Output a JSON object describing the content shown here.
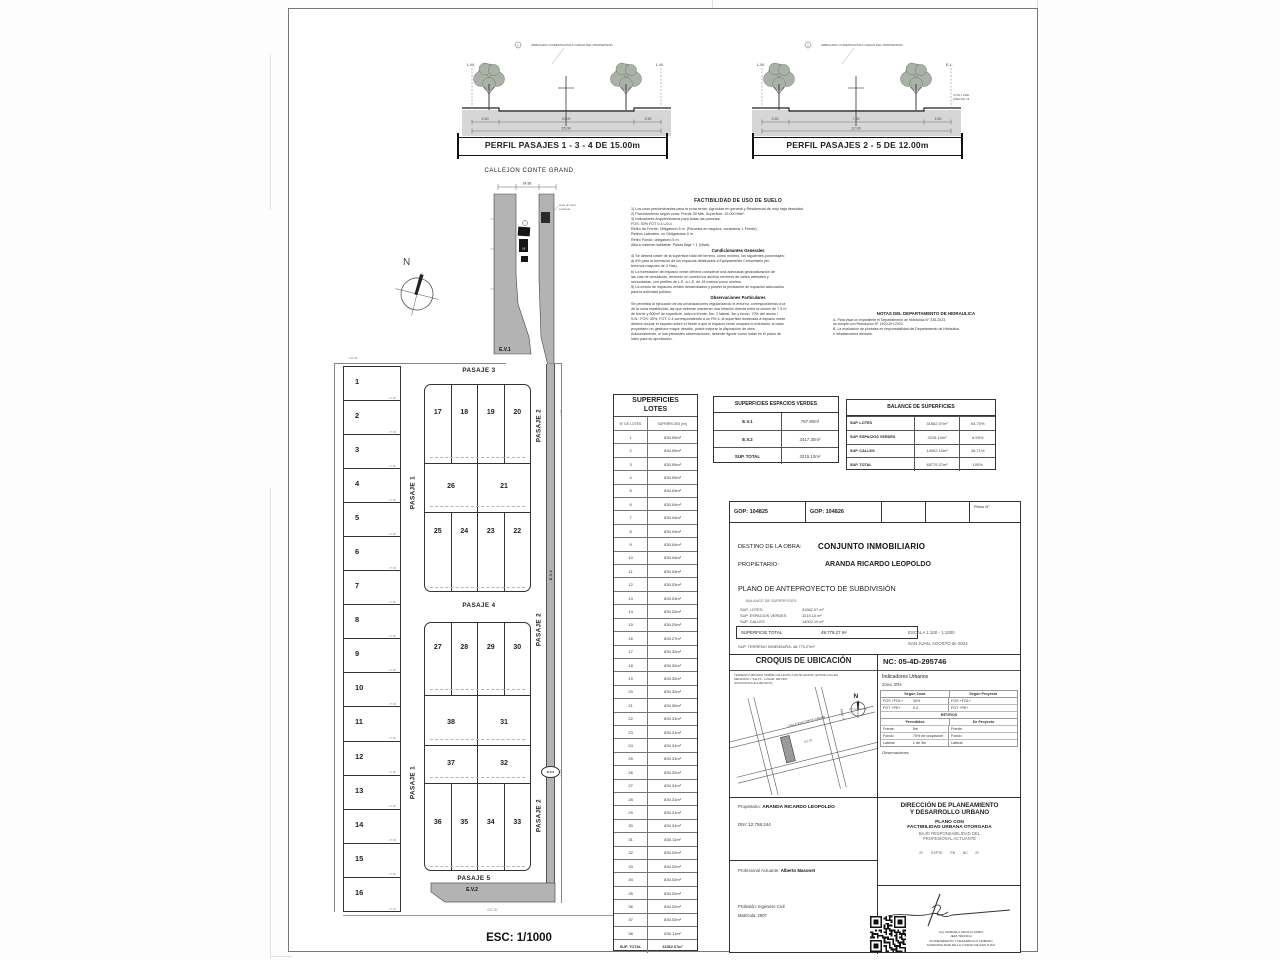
{
  "sheet": {
    "esc_label": "ESC: 1/1000"
  },
  "profiles": {
    "left": {
      "title": "PERFIL PASAJES 1 - 3 - 4 DE 15.00m",
      "dims": [
        "2.50",
        "10.00",
        "2.50"
      ],
      "total": "15.00",
      "lm_left": "L.M.",
      "lm_right": "L.M.",
      "note": "ARBOLADO: FORESTACIÓN A CARGO DEL PROPIETARIO"
    },
    "right": {
      "title": "PERFIL PASAJES 2 - 5 DE 12.00m",
      "dims": [
        "2.50",
        "7.00",
        "2.50"
      ],
      "total": "12.00",
      "lm_left": "L.M.",
      "lm_right": "E.L.",
      "note": "ARBOLADO: FORESTACIÓN A CARGO DEL PROPIETARIO",
      "side_note_1": "LOTE 1 FRENTISTA",
      "side_note_2": "LÍNEA DE CIERRE"
    }
  },
  "plan": {
    "callejon_label": "CALLEJON CONTE GRAND",
    "ev1": "E.V.1",
    "ev2": "E.V.2",
    "north": "N",
    "pasaje1": "PASAJE 1",
    "pasaje2": "PASAJE 2",
    "pasaje3": "PASAJE 3",
    "pasaje4": "PASAJE 4",
    "pasaje5": "PASAJE 5",
    "corridor_dim": "34.88",
    "corridor_note_1": "línea de cierre",
    "corridor_note_2": "existente",
    "corridor_lot": "18",
    "top_dim": "111.86",
    "bottom_dim": "432.30",
    "side_dim_1": "1.94",
    "side_dim_2": "4.64",
    "left_lots": {
      "numbers": [
        1,
        2,
        3,
        4,
        5,
        6,
        7,
        8,
        9,
        10,
        11,
        12,
        13,
        14,
        15,
        16
      ],
      "divider_dim": "27.86"
    },
    "upper_block": {
      "rows": [
        [
          17,
          18,
          19,
          20
        ],
        [
          26,
          21
        ],
        [
          25,
          24,
          23,
          22
        ]
      ]
    },
    "lower_block": {
      "rows": [
        [
          27,
          28,
          29,
          30
        ],
        [
          38,
          31
        ],
        [
          37,
          32
        ],
        [
          36,
          35,
          34,
          33
        ]
      ]
    }
  },
  "factibilidad": {
    "title": "FACTIBILIDAD DE USO DE SUELO",
    "lines": [
      "1) Los usos predominantes para la zona serán: Agrícolas en general y Residencial de muy baja densidad.",
      "2) Parcelamiento según zona: Frente 30 Mts. Superficie: 10.000 Mts².",
      "3) Indicadores Arquitectónicos para todas las parcelas:",
      "      FOS: 30%   FOT 0.4 L/0.4",
      "      Retiro de Frente: Obligatorio 5 m. (Parcelas en esquina, considerar 1 Frente).",
      "      Retiros Laterales: no Obligatorios 0 m.",
      "      Retiro Fondo: obligatorio 5 m.",
      "      Altura máxima habitable: Planta Baja + 1 (Nivel).",
      "##Condicionantes Generales",
      "4) Se deberá ceder de la superficie total del terreno, como mínimo, los siguientes porcentajes:",
      "      a) 6% para la formación de los espacios destinados a Equipamiento Comunitario (en",
      "      terrenos mayores de 3 Has).",
      "      b) La forestación del espacio verde deberá considerar una adecuada geolocalización de",
      "      las vías de circulación, teniendo en cuenta los anchos mínimos de calles arteriales y",
      "      secundarias, con perfiles de L.E. a L.E. de 15 metros como mínimo.",
      "5) La cesión de espacios verdes desarrollados y poseer la prestación de espacios adecuados",
      "para la actividad pública.",
      "##Observaciones Particulares",
      "Se permitirá la ejecución de las urbanizaciones regularizando el entorno, correspondiendo a la",
      "de la zona establecida; las que deberán mantener una relación directa entre la cesión de 7.5 m",
      "de frente y 800m² de superficie, salvo el frente: 5m, 1 lateral: 3m y fondo: 70% del ancho /",
      "S.N.: FOS: 30%, FOT: 0.4 correspondiendo a un FM 4; la superficie destinada a espacio verde",
      "deberá ocupar el espacio sobre el frente a que el espacio verde ocupara lo entubado; si cada",
      "propietario no gestione mayor desafío, podrá mejorar la disposición de obra.",
      "Adicionalmente, si sus presentes observaciones, deberán figurar como notas en el plano de",
      "loteo para su aprobación."
    ]
  },
  "hidraulica": {
    "title": "NOTAS DEL DEPARTAMENTO DE HIDRAULICA",
    "lines": [
      "A- Para visar un expediente el Departamento de Hidráulica N° 335-2023,",
      "     se cumple con Resolución N° 1520-DH-2023.",
      "B- La evaluación de pluviales es responsabilidad del Departamento de Hidráulica",
      "     e infraestructura aledaña."
    ]
  },
  "lots_table": {
    "title1": "SUPERFICIES",
    "title2": "LOTES",
    "col1": "N° DE LOTES",
    "col2": "SUPERFICIES (m²)",
    "rows": [
      [
        "1",
        "830.09m²"
      ],
      [
        "2",
        "830.09m²"
      ],
      [
        "3",
        "830.09m²"
      ],
      [
        "4",
        "830.09m²"
      ],
      [
        "5",
        "830.04m²"
      ],
      [
        "6",
        "830.04m²"
      ],
      [
        "7",
        "830.04m²"
      ],
      [
        "8",
        "830.04m²"
      ],
      [
        "9",
        "830.04m²"
      ],
      [
        "10",
        "830.04m²"
      ],
      [
        "11",
        "830.03m²"
      ],
      [
        "12",
        "830.03m²"
      ],
      [
        "13",
        "830.03m²"
      ],
      [
        "14",
        "830.20m²"
      ],
      [
        "15",
        "830.20m²"
      ],
      [
        "16",
        "830.27m²"
      ],
      [
        "17",
        "830.32m²"
      ],
      [
        "18",
        "830.32m²"
      ],
      [
        "19",
        "830.32m²"
      ],
      [
        "20",
        "830.32m²"
      ],
      [
        "21",
        "830.30m²"
      ],
      [
        "22",
        "830.31m²"
      ],
      [
        "23",
        "830.31m²"
      ],
      [
        "24",
        "830.31m²"
      ],
      [
        "25",
        "830.31m²"
      ],
      [
        "26",
        "830.32m²"
      ],
      [
        "27",
        "830.31m²"
      ],
      [
        "28",
        "830.31m²"
      ],
      [
        "29",
        "830.31m²"
      ],
      [
        "30",
        "830.31m²"
      ],
      [
        "31",
        "830.11m²"
      ],
      [
        "32",
        "830.02m²"
      ],
      [
        "33",
        "830.02m²"
      ],
      [
        "34",
        "830.02m²"
      ],
      [
        "35",
        "830.02m²"
      ],
      [
        "36",
        "830.02m²"
      ],
      [
        "37",
        "830.02m²"
      ],
      [
        "38",
        "830.11m²"
      ]
    ],
    "total_label": "SUP. TOTAL",
    "total_value": "31562.07m²"
  },
  "verdes_table": {
    "title": "SUPERFICIES ESPACIOS VERDES",
    "rows": [
      [
        "E.V.1",
        "797.80m²"
      ],
      [
        "E.V.2",
        "2417.30m²"
      ],
      [
        "SUP. TOTAL",
        "3215.10m²"
      ]
    ]
  },
  "balance_table": {
    "title": "BALANCE DE SUPERFICIES",
    "rows": [
      [
        "SUP. LOTES",
        "31562.07m²",
        "64.70%"
      ],
      [
        "SUP. ESPACIOS VERDES",
        "3215.10m²",
        "6.59%"
      ],
      [
        "SUP. CALLES",
        "14002.10m²",
        "28.71%"
      ],
      [
        "SUP. TOTAL",
        "48779.27m²",
        "100%"
      ]
    ]
  },
  "title_block": {
    "gop1": "GOP:   104825",
    "gop2": "GOP:   104826",
    "plano_n": "Plano N°",
    "destino_label": "DESTINO DE LA OBRA:",
    "destino": "CONJUNTO INMOBILIARIO",
    "prop_label": "PROPIETARIO:",
    "prop": "ARANDA RICARDO LEOPOLDO",
    "plano": "PLANO DE ANTEPROYECTO DE SUBDIVISIÓN",
    "balance_mini_title": "BALANCE  DE  SUPERFICIES",
    "mini1l": "SUP. LOTES",
    "mini1v": "31562.07 m²",
    "mini2l": "SUP. ESPACIOS VERDES",
    "mini2v": "3215.10 m²",
    "mini3l": "SUP. CALLES",
    "mini3v": "14002.10 m²",
    "sup_total_label": "SUPERFICIE TOTAL",
    "sup_total": "48.779,27 m²",
    "terreno": "SUP. TERRENO S/MENSURA:   48.779,27m²",
    "escala": "ESCALA    1:100 - 1:1000",
    "fecha": "SAN JUAN, AGOSTO de 2024",
    "croquis_title": "CROQUIS DE UBICACIÓN",
    "croquis_desc_1": "TERRENO UBICADO SOBRE CALLEJÓN CONTE GRAND, ENTRE CALLES",
    "croquis_desc_2": "MENDOZA Y SALTA - LUGAR: RETIRO",
    "croquis_desc_3": "(DISTANCIAS EN METROS)",
    "croquis_street1": "CALLEJON CONTE GRAND",
    "croquis_street2": "PROL. 5",
    "croquis_dim": "452.30",
    "croquis_north": "N",
    "nc": "NC:  05-4D-295746",
    "indicadores_title": "Indicadores Urbanos",
    "zona": "Zona:  ZRe",
    "ind_col1": "Según Zona",
    "ind_col2": "Según Proyecto",
    "ind_r1": [
      "FOS +FOL+",
      "30%",
      "FOS +FOL+",
      ""
    ],
    "ind_r2": [
      "FOT +PE+",
      "0.4",
      "FOT +PE+",
      ""
    ],
    "retiros": "RETIROS",
    "permitidos": "Permitidos",
    "de_proyecto": "De Proyecto",
    "ret_r1": [
      "Frente:",
      "5m",
      "Frente:",
      ""
    ],
    "ret_r2": [
      "Fondo:",
      "70% de ocupación",
      "Fondo:",
      ""
    ],
    "ret_r3": [
      "Lateral:",
      "1 de 3m",
      "Lateral:",
      ""
    ],
    "observaciones": "Observaciones",
    "prop2_label": "Propietario:",
    "prop2": "ARANDA RICARDO LEOPOLDO",
    "dni": "DNI:   12.758.244",
    "prof_label": "Profesional Actuante:",
    "prof": "Alberto Masonet",
    "profesion": "Profesión: Ingeniero Civil",
    "matricula": "Matrícula: 2907",
    "direccion1": "DIRECCIÓN DE PLANEAMIENTO",
    "direccion2": "Y DESARROLLO URBANO",
    "plano_con": "PLANO CON",
    "fact_otorgada": "FACTIBILIDAD URBANA OTORGADA",
    "bajo": "BAJO RESPONSABILIDAD DEL",
    "prof_act": "PROFESIONAL ACTUANTE",
    "ref_line": "N°        EXPTE        FB        NC        N°",
    "firma_1": "Arq. MARCELA CECILIA SORIA",
    "firma_2": "JEFA TÉCNICA",
    "firma_3": "PLANEAMIENTO Y DESARROLLO URBANO",
    "firma_4": "MUNICIPALIDAD DE LA CIUDAD DE SAN JUAN"
  }
}
